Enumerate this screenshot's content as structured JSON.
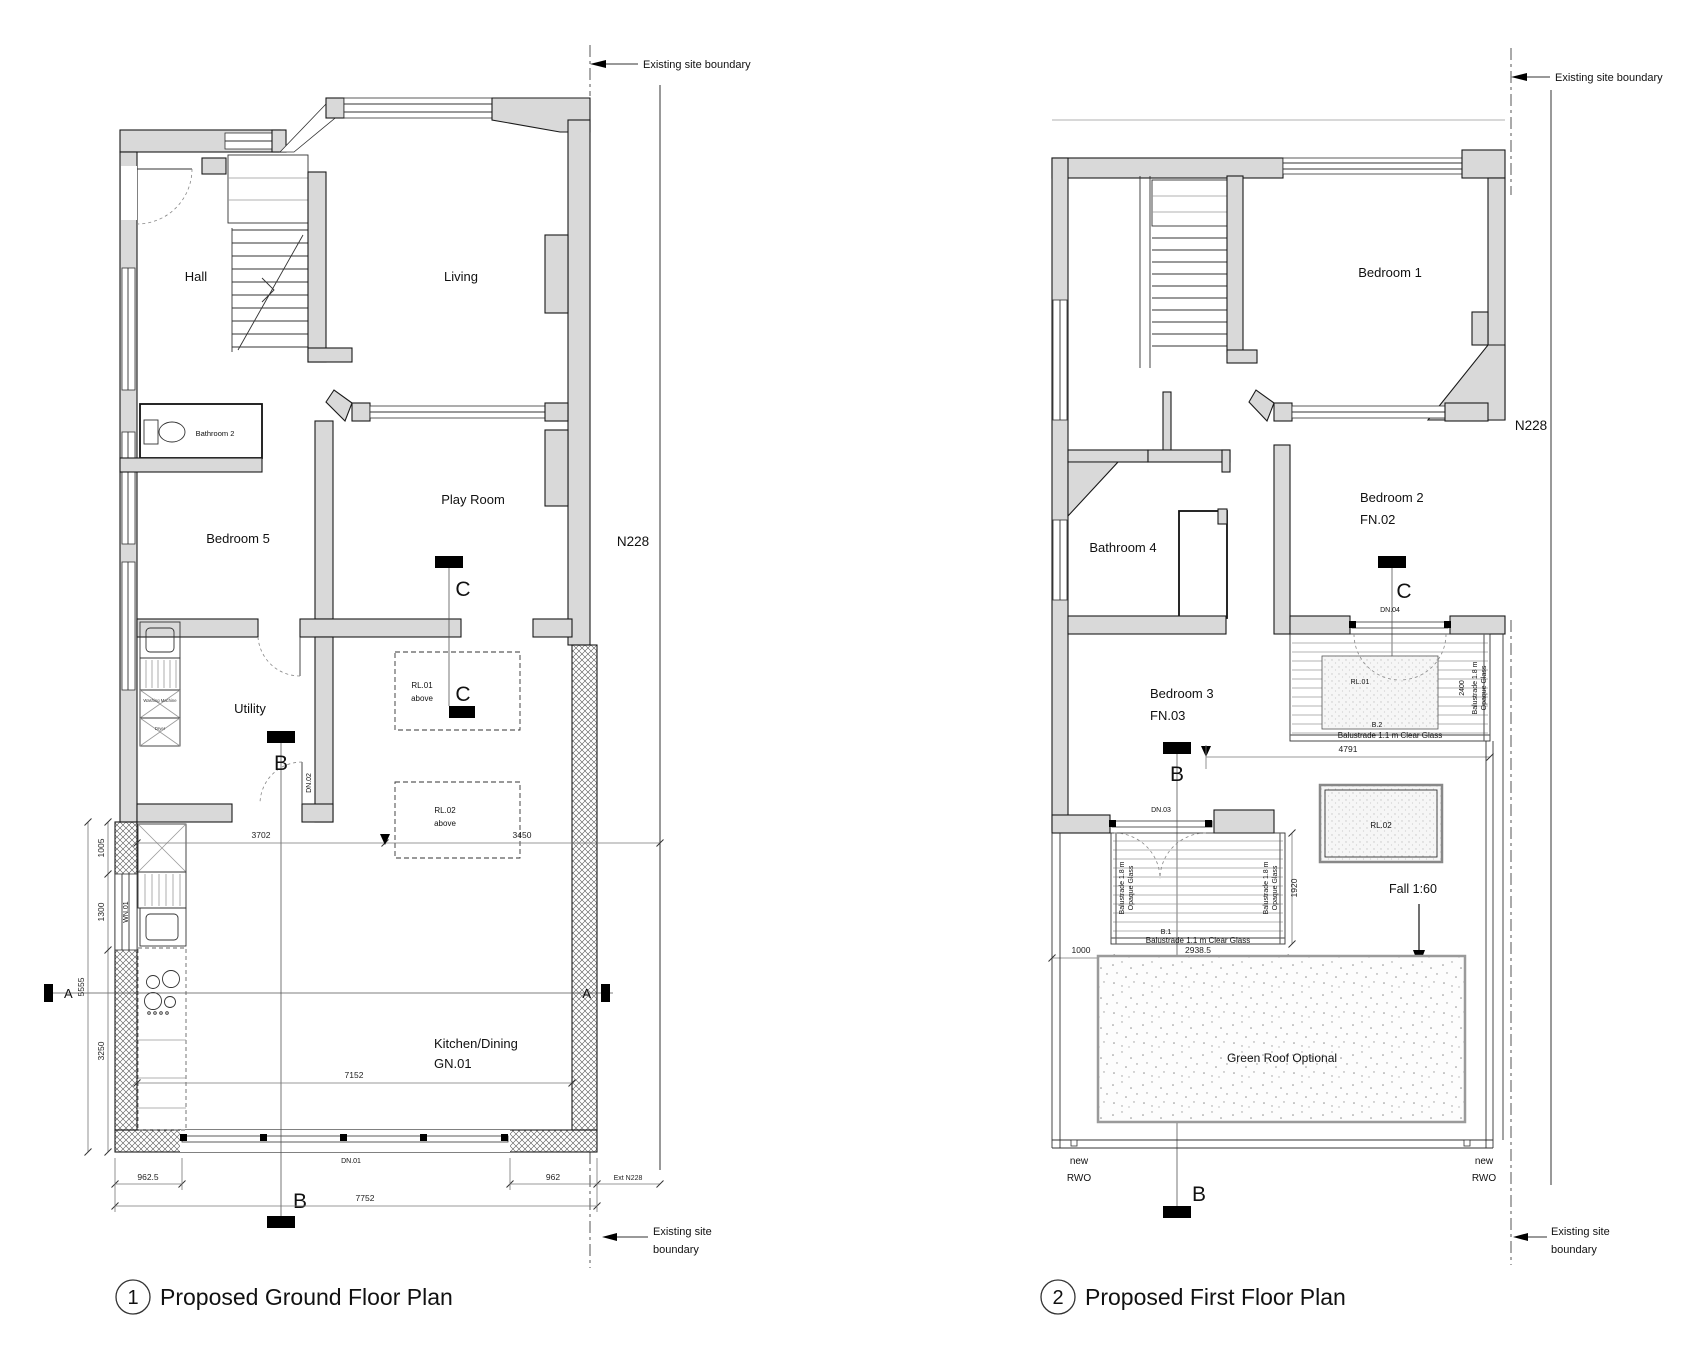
{
  "titles": {
    "t1_num": "1",
    "t1": "Proposed Ground Floor Plan",
    "t2_num": "2",
    "t2": "Proposed First Floor Plan"
  },
  "common": {
    "site_boundary": "Existing site boundary",
    "site_line1": "Existing site",
    "site_line2": "boundary",
    "n228": "N228",
    "new": "new",
    "rwo": "RWO"
  },
  "gf": {
    "hall": "Hall",
    "living": "Living",
    "bathroom2": "Bathroom 2",
    "bedroom5": "Bedroom 5",
    "playroom": "Play Room",
    "utility": "Utility",
    "kitchen": "Kitchen/Dining",
    "gn01": "GN.01",
    "rl01": "RL.01",
    "rl02": "RL.02",
    "above": "above",
    "dn01": "DN.01",
    "dn02": "DN.02",
    "wn01": "WN.01",
    "washing": "Washing Machine",
    "dryer": "Dryer",
    "d3702": "3702",
    "d3450": "3450",
    "d7152": "7152",
    "d962_5": "962.5",
    "d7752": "7752",
    "d962": "962",
    "ext_n228": "Ext N228",
    "d1005": "1005",
    "d1300": "1300",
    "d5555": "5555",
    "d3250": "3250",
    "sa": "A",
    "sb": "B",
    "sc": "C"
  },
  "ff": {
    "bedroom1": "Bedroom 1",
    "bathroom4": "Bathroom 4",
    "bedroom2": "Bedroom 2",
    "fn02": "FN.02",
    "bedroom3": "Bedroom 3",
    "fn03": "FN.03",
    "dn03": "DN.03",
    "dn04": "DN.04",
    "rl01": "RL.01",
    "rl02": "RL.02",
    "b1": "B.1",
    "b2": "B.2",
    "bal_clear": "Balustrade 1.1 m Clear Glass",
    "bal_opaque1": "Balustrade 1.8 m",
    "bal_opaque2": "Opaque Glass",
    "fall": "Fall 1:60",
    "green_roof": "Green Roof Optional",
    "d4791": "4791",
    "d2938_5": "2938.5",
    "d1000": "1000",
    "d1920": "1920",
    "d2400": "2400",
    "sb": "B",
    "sc": "C"
  }
}
